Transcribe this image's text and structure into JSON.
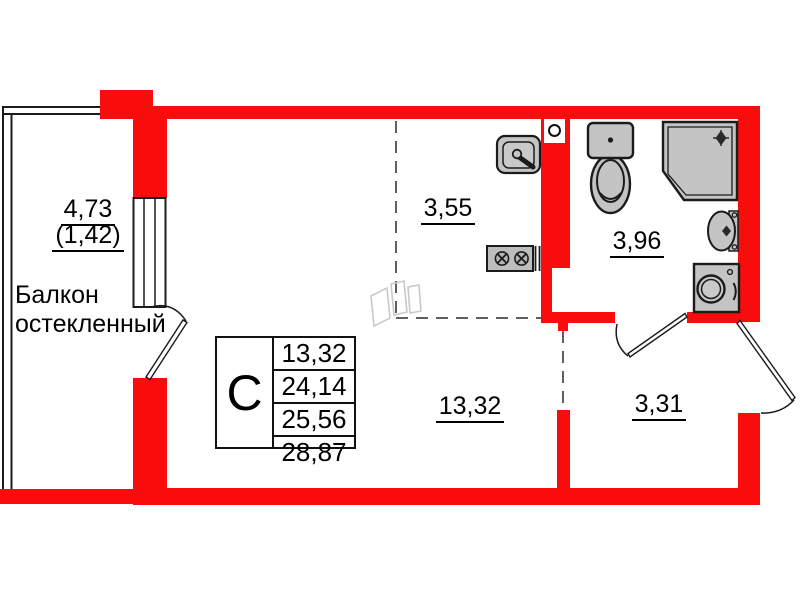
{
  "colors": {
    "wall": "#F80C0C",
    "fixture_fill": "#C4C4C4",
    "outline": "#1B1B1B",
    "dashed_line": "#5F5F5F",
    "furniture_sketch": "#C9C9C9"
  },
  "rooms": {
    "balcony": {
      "area": "4,73",
      "area_coefficient": "(1,42)",
      "label_line1": "Балкон",
      "label_line2": "остекленный"
    },
    "kitchen_niche": {
      "area": "3,55"
    },
    "bathroom": {
      "area": "3,96"
    },
    "living_room": {
      "area": "13,32"
    },
    "hallway": {
      "area": "3,31"
    }
  },
  "info_table": {
    "type_label": "С",
    "values": [
      "13,32",
      "24,14",
      "25,56",
      "28,87"
    ]
  },
  "fixtures": [
    "kitchen-sink-icon",
    "stove-icon",
    "vent-duct-icon",
    "toilet-icon",
    "shower-cabin-icon",
    "wash-basin-icon",
    "washing-machine-icon",
    "wardrobe-sketch-icon"
  ]
}
